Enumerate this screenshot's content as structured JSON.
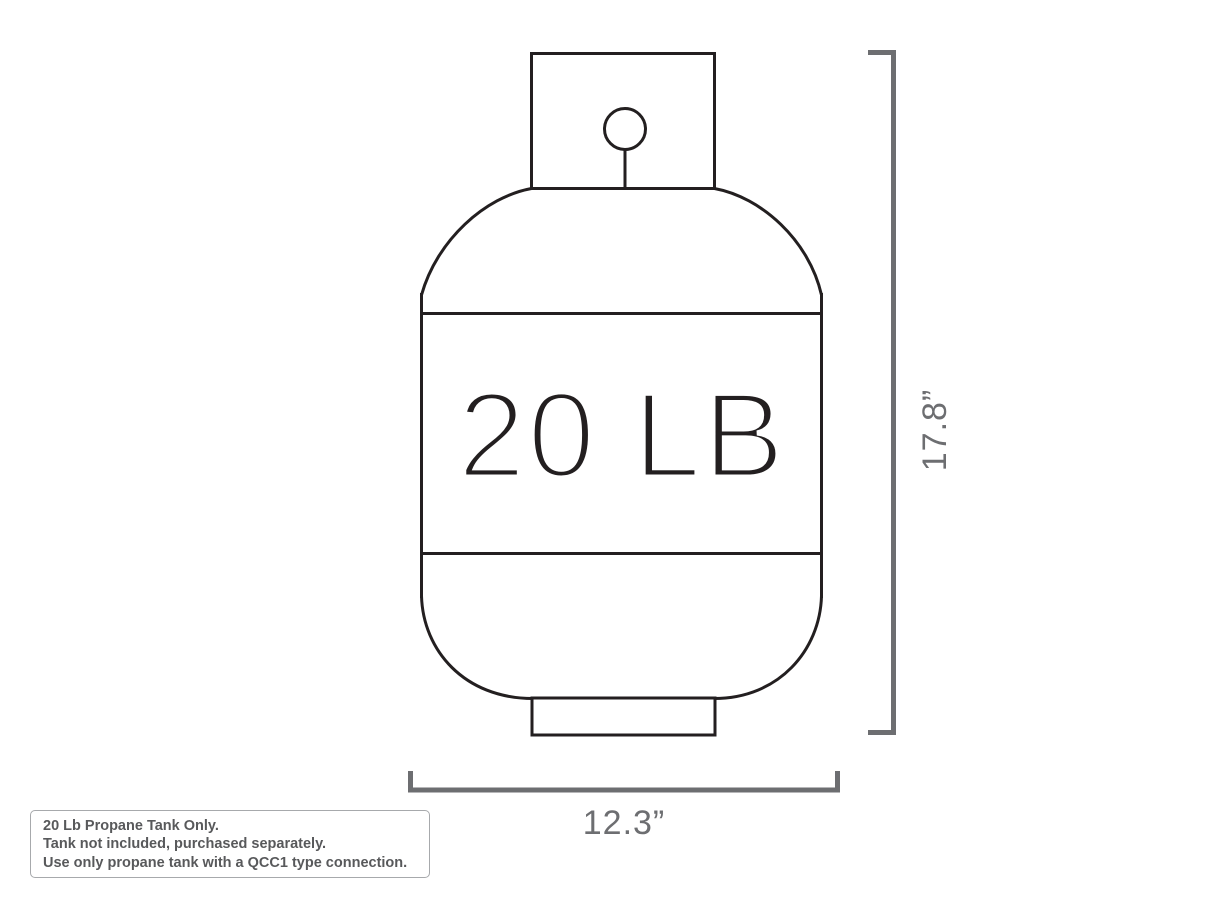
{
  "canvas": {
    "width": 1214,
    "height": 911,
    "background": "#ffffff"
  },
  "colors": {
    "tank_outline": "#231f20",
    "dimension_gray": "#6d6e71",
    "note_text_gray": "#58595b",
    "note_border_gray": "#a7a9ac"
  },
  "tank": {
    "label": "20 LB"
  },
  "dimensions": {
    "height_label": "17.8”",
    "width_label": "12.3”"
  },
  "note_box": {
    "lines": [
      "20 Lb Propane Tank Only.",
      "Tank not included, purchased separately.",
      "Use only propane tank with a QCC1 type connection."
    ]
  }
}
